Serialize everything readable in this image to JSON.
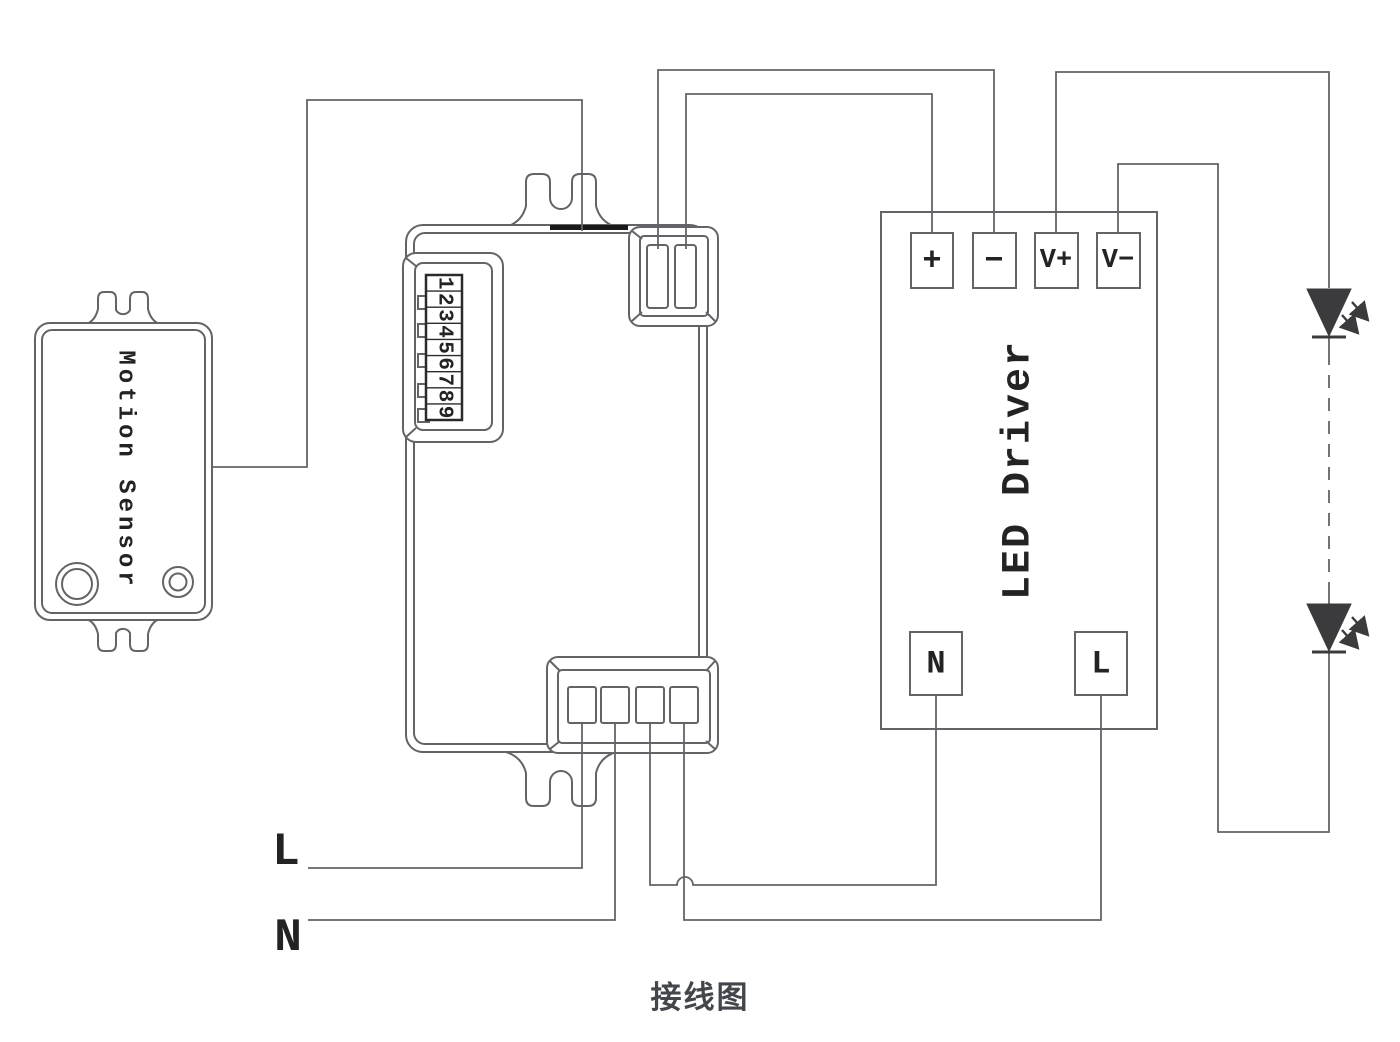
{
  "title": "接线图",
  "colors": {
    "background": "#ffffff",
    "line": "#636468",
    "text": "#232224",
    "led_fill": "#3b3b3d",
    "accent_bar": "#1a1a1a"
  },
  "motion_sensor": {
    "label": "Motion Sensor"
  },
  "controller": {
    "dip_switch": {
      "digits": [
        "1",
        "2",
        "3",
        "4",
        "5",
        "6",
        "7",
        "8",
        "9"
      ],
      "slider_count": 5
    },
    "top_terminal_count": 2,
    "bottom_terminal_count": 4
  },
  "led_driver": {
    "label": "LED Driver",
    "terminals": {
      "plus": "+",
      "minus": "−",
      "vplus": "V+",
      "vminus": "V−",
      "neutral": "N",
      "live": "L"
    }
  },
  "mains": {
    "live": "L",
    "neutral": "N"
  },
  "leds": {
    "count": 2,
    "icon": "led-diode-emitting-icon"
  }
}
